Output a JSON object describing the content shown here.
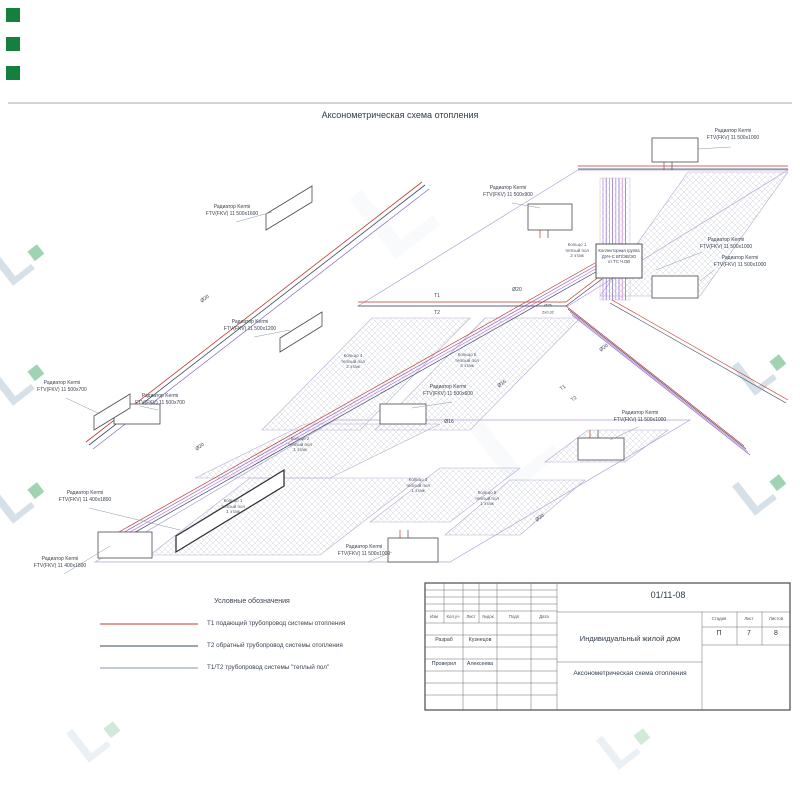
{
  "sheet": {
    "title": "Аксонометрическая схема отопления",
    "doc_number": "01/11-08",
    "project_name": "Индивидуальный жилой дом",
    "drawing_name": "Аксонометрическая схема отопления",
    "stage_label": "Стадия",
    "stage_value": "П",
    "sheet_label": "Лист",
    "sheet_value": "7",
    "sheets_label": "Листов",
    "sheets_value": "8",
    "header_cols": [
      "Изм",
      "Кол.уч",
      "Лист",
      "№док",
      "Подп",
      "Дата"
    ],
    "signatures": [
      {
        "role": "Разраб",
        "name": "Кузнецов"
      },
      {
        "role": "Проверил",
        "name": "Алексеева"
      }
    ]
  },
  "legend": {
    "title": "Условные обозначения",
    "items": [
      {
        "label": "Т1 подающий трубопровод системы отопления",
        "color": "#c0392b"
      },
      {
        "label": "Т2 обратный трубопровод системы отопления",
        "color": "#3a4a63"
      },
      {
        "label": "Т1/Т2 трубопровод системы \"теплый пол\"",
        "color": "#8a94a8"
      }
    ]
  },
  "diagram": {
    "radiator_labels": [
      {
        "l1": "Радиатор Kermi",
        "l2": "FTV(FKV) 11 500x1600"
      },
      {
        "l1": "Радиатор Kermi",
        "l2": "FTV(FKV) 11 500x1200"
      },
      {
        "l1": "Радиатор Kermi",
        "l2": "FTV(FKV) 11 500x700"
      },
      {
        "l1": "Радиатор Kermi",
        "l2": "FTV(FKV) 11 500x700"
      },
      {
        "l1": "Радиатор Kermi",
        "l2": "FTV(FKV) 11 400x1800"
      },
      {
        "l1": "Радиатор Kermi",
        "l2": "FTV(FKV) 11 400x1800"
      },
      {
        "l1": "Радиатор Kermi",
        "l2": "FTV(FKV) 11 500x900"
      },
      {
        "l1": "Радиатор Kermi",
        "l2": "FTV(FKV) 11 500x1000"
      },
      {
        "l1": "Радиатор Kermi",
        "l2": "FTV(FKV) 11 500x1000"
      },
      {
        "l1": "Радиатор Kermi",
        "l2": "FTV(FKV) 11 500x1000"
      },
      {
        "l1": "Радиатор Kermi",
        "l2": "FTV(FKV) 11 500x600"
      },
      {
        "l1": "Радиатор Kermi",
        "l2": "FTV(FKV) 11 500x1000"
      },
      {
        "l1": "Радиатор Kermi",
        "l2": "FTV(FKV) 11 500x1000"
      }
    ],
    "loop_labels": [
      {
        "l1": "Кольцо 1",
        "l2": "теплый пол",
        "l3": "2 этаж"
      },
      {
        "l1": "Кольцо 4",
        "l2": "теплый пол",
        "l3": "2 этаж"
      },
      {
        "l1": "Кольцо 5",
        "l2": "теплый пол",
        "l3": "2 этаж"
      },
      {
        "l1": "Кольцо 2",
        "l2": "теплый пол",
        "l3": "1 этаж"
      },
      {
        "l1": "Кольцо 1",
        "l2": "теплый пол",
        "l3": "1 этаж"
      },
      {
        "l1": "Кольцо 3",
        "l2": "теплый пол",
        "l3": "1 этаж"
      },
      {
        "l1": "Кольцо 5",
        "l2": "теплый пол",
        "l3": "1 этаж"
      }
    ],
    "manifold": {
      "l1": "Коллекторная группа",
      "l2": "ДУН-С ВП/ЭВ/ЭО",
      "l3": "от ТС Ч.ОВ"
    },
    "pipe_labels": [
      {
        "text": "Ø20"
      },
      {
        "text": "Ø20"
      },
      {
        "text": "Ø20"
      },
      {
        "text": "Ø20"
      },
      {
        "text": "Ø20"
      },
      {
        "text": "Ø16"
      },
      {
        "text": "Ø16"
      },
      {
        "text": "Т1"
      },
      {
        "text": "Т2"
      },
      {
        "text": "Т1"
      },
      {
        "text": "Т2"
      },
      {
        "text": "Ø25"
      },
      {
        "text": "2x0,32"
      }
    ]
  },
  "watermark": {
    "glyph": "L"
  },
  "colors": {
    "t1_supply": "#c0392b",
    "t2_return": "#3a4a63",
    "floor_heating": "#8468c9",
    "floor_heating_alt": "#c77bd4",
    "logo_green": "#15803d",
    "watermark_blue": "#a4bcd0",
    "hatch": "#c5cbd6"
  }
}
